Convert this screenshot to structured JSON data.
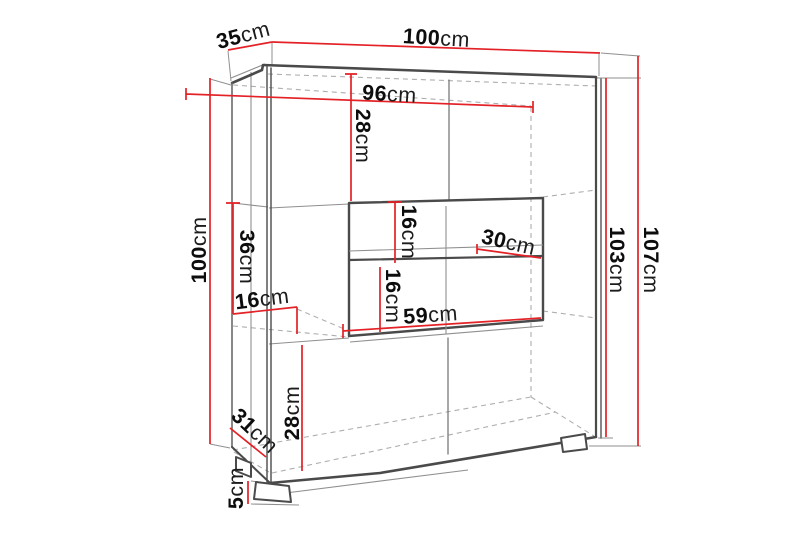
{
  "diagram": {
    "unit": "cm",
    "colors": {
      "dimension_red": "#e32126",
      "outline_gray": "#4a4a4a",
      "hidden_gray": "#aeaeae",
      "label_black": "#0d0d0d",
      "background": "#ffffff"
    },
    "dimensions": {
      "top_depth": {
        "value": "35",
        "unit": "cm"
      },
      "top_width": {
        "value": "100",
        "unit": "cm"
      },
      "interior_width": {
        "value": "96",
        "unit": "cm"
      },
      "upper_section_height": {
        "value": "28",
        "unit": "cm"
      },
      "left_height": {
        "value": "100",
        "unit": "cm"
      },
      "middle_section_height": {
        "value": "36",
        "unit": "cm"
      },
      "side_shelf_depth": {
        "value": "16",
        "unit": "cm"
      },
      "niche_upper_height": {
        "value": "16",
        "unit": "cm"
      },
      "shelf_depth": {
        "value": "30",
        "unit": "cm"
      },
      "niche_lower_height": {
        "value": "16",
        "unit": "cm"
      },
      "niche_width": {
        "value": "59",
        "unit": "cm"
      },
      "body_height": {
        "value": "103",
        "unit": "cm"
      },
      "total_height": {
        "value": "107",
        "unit": "cm"
      },
      "lower_section_height": {
        "value": "28",
        "unit": "cm"
      },
      "bottom_depth": {
        "value": "31",
        "unit": "cm"
      },
      "foot_height": {
        "value": "5",
        "unit": "cm"
      }
    }
  }
}
